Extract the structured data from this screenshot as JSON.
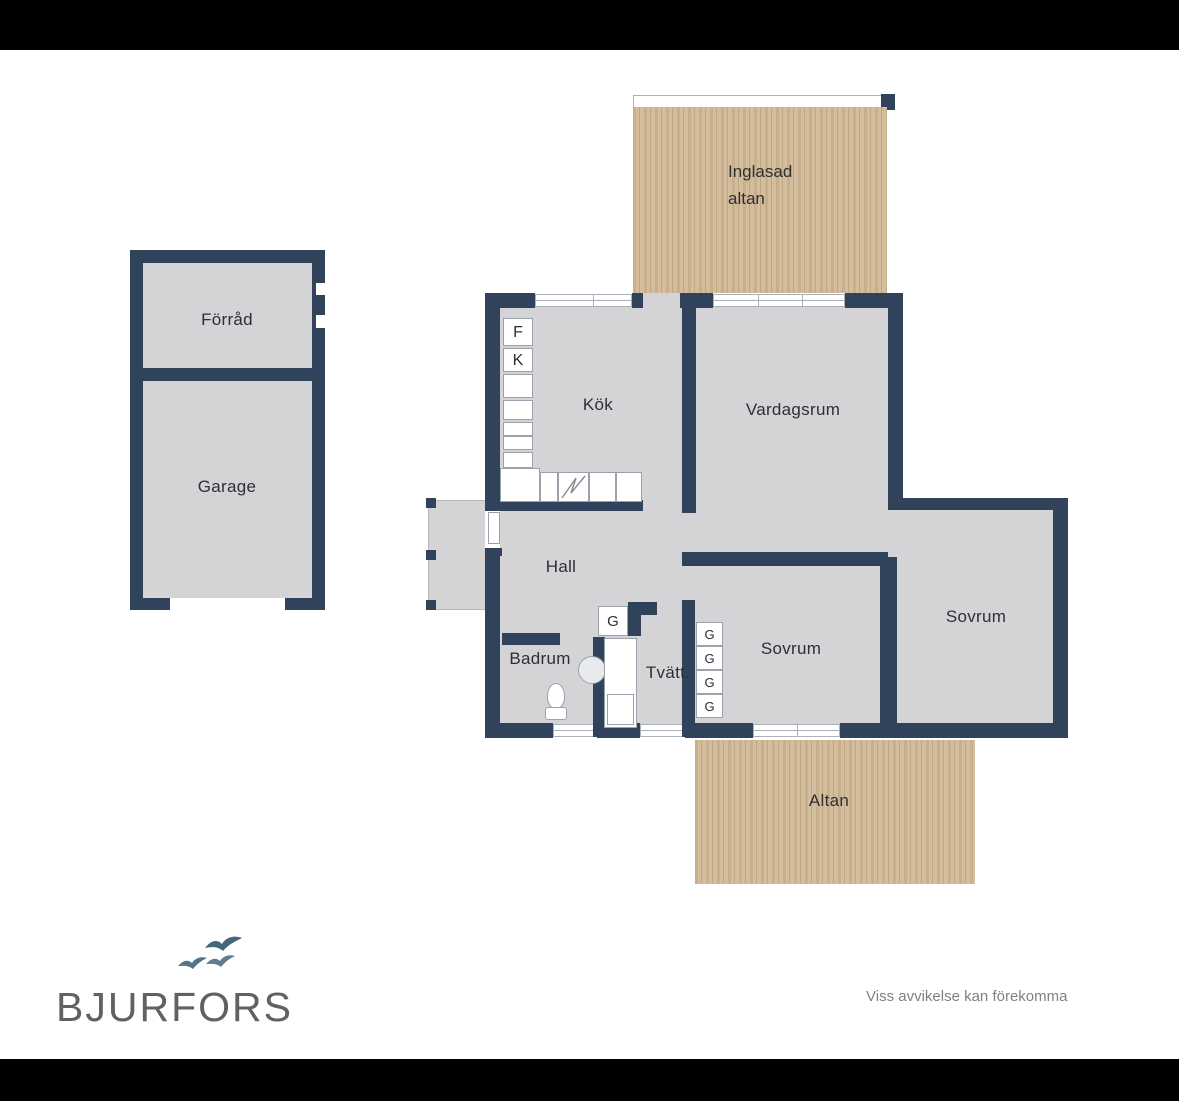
{
  "branding": {
    "logo_text": "BJURFORS",
    "disclaimer": "Viss avvikelse kan förekomma"
  },
  "floor_plan": {
    "outbuilding": {
      "rooms": [
        {
          "id": "forrad",
          "label": "Förråd"
        },
        {
          "id": "garage",
          "label": "Garage"
        }
      ]
    },
    "house": {
      "rooms": [
        {
          "id": "kok",
          "label": "Kök"
        },
        {
          "id": "vardagsrum",
          "label": "Vardagsrum"
        },
        {
          "id": "hall",
          "label": "Hall"
        },
        {
          "id": "badrum",
          "label": "Badrum"
        },
        {
          "id": "tvatt",
          "label": "Tvätt."
        },
        {
          "id": "sovrum-left",
          "label": "Sovrum"
        },
        {
          "id": "sovrum-right",
          "label": "Sovrum"
        }
      ]
    },
    "decks": [
      {
        "id": "inglasad-altan",
        "label_line1": "Inglasad",
        "label_line2": "altan"
      },
      {
        "id": "altan",
        "label": "Altan"
      }
    ],
    "appliance_labels": {
      "f": "F",
      "k": "K",
      "g": "G"
    }
  },
  "colors": {
    "wall": "#31435a",
    "floor": "#d4d4d6",
    "wood_base": "#c8b08e",
    "bird": "#44657b",
    "logo": "#5f6265"
  }
}
